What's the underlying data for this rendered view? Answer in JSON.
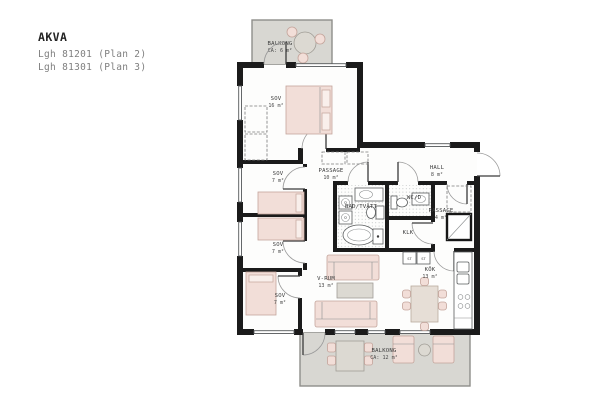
{
  "title_block": {
    "project": "AKVA",
    "apartments": [
      "Lgh 81201 (Plan 2)",
      "Lgh 81301 (Plan 3)"
    ]
  },
  "rooms": [
    {
      "name": "SOV",
      "area": "16 m²"
    },
    {
      "name": "SOV",
      "area": "7 m²"
    },
    {
      "name": "SOV",
      "area": "7 m²"
    },
    {
      "name": "SOV",
      "area": "7 m²"
    },
    {
      "name": "PASSAGE",
      "area": "10 m²"
    },
    {
      "name": "HALL",
      "area": "8 m²"
    },
    {
      "name": "BAD/TVÄTT",
      "area": ""
    },
    {
      "name": "WC/D",
      "area": ""
    },
    {
      "name": "KLK",
      "area": ""
    },
    {
      "name": "PASSAGE",
      "area": "4 m²"
    },
    {
      "name": "KÖK",
      "area": "13 m²"
    },
    {
      "name": "V-RUM",
      "area": "13 m²"
    }
  ],
  "balconies": [
    {
      "name": "BALKONG",
      "area": "CA: 6 m²"
    },
    {
      "name": "BALKONG",
      "area": "CA: 12 m²"
    }
  ],
  "fixtures": {
    "tall_cabinet_label": "ST"
  },
  "colors": {
    "wall": "#1b1b1b",
    "furniture_fill": "#f2ded8",
    "furniture_stroke": "#c3a49b",
    "balcony_fill": "#d8d7d2",
    "table_fill": "#e6ded6",
    "tile_dot": "#a9aeae"
  }
}
